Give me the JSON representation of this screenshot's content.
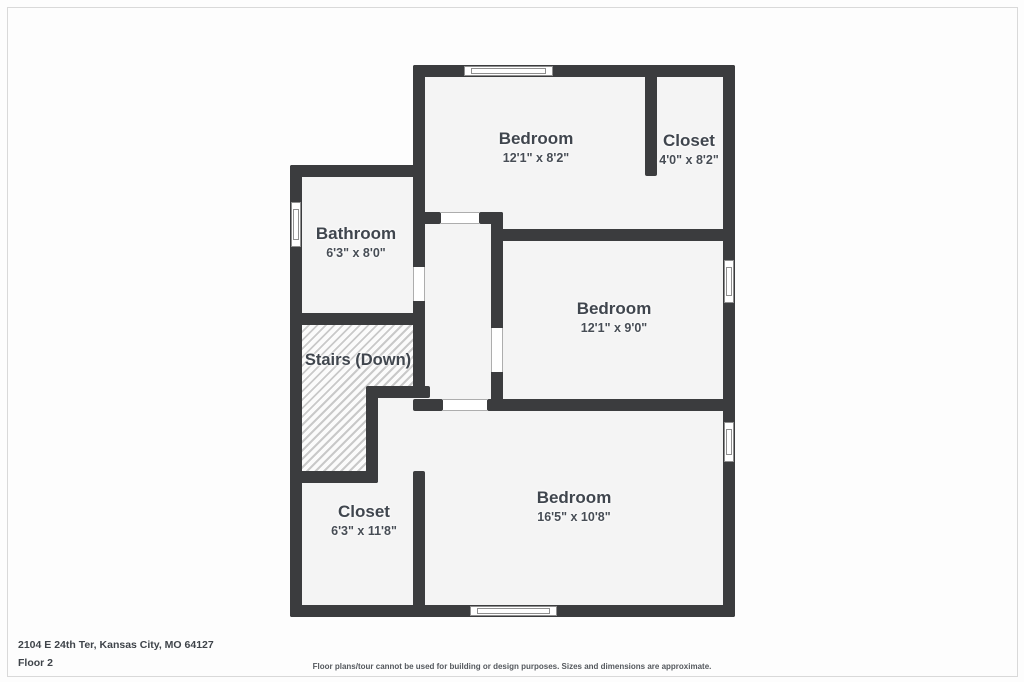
{
  "plan": {
    "rooms": [
      {
        "id": "bedroom-top",
        "name": "Bedroom",
        "dims": "12'1\" x 8'2\""
      },
      {
        "id": "closet-top",
        "name": "Closet",
        "dims": "4'0\" x 8'2\""
      },
      {
        "id": "bathroom",
        "name": "Bathroom",
        "dims": "6'3\" x 8'0\""
      },
      {
        "id": "bedroom-middle",
        "name": "Bedroom",
        "dims": "12'1\" x 9'0\""
      },
      {
        "id": "stairs",
        "name": "Stairs (Down)",
        "dims": ""
      },
      {
        "id": "closet-bottom",
        "name": "Closet",
        "dims": "6'3\" x 11'8\""
      },
      {
        "id": "bedroom-bottom",
        "name": "Bedroom",
        "dims": "16'5\" x 10'8\""
      }
    ]
  },
  "footer": {
    "address": "2104 E 24th Ter, Kansas City, MO 64127",
    "floor": "Floor 2",
    "disclaimer": "Floor plans/tour cannot be used for building or design purposes. Sizes and dimensions are approximate."
  },
  "colors": {
    "wall": "#3b3c3e",
    "room_fill": "#f4f4f4",
    "label_text": "#40464e"
  }
}
